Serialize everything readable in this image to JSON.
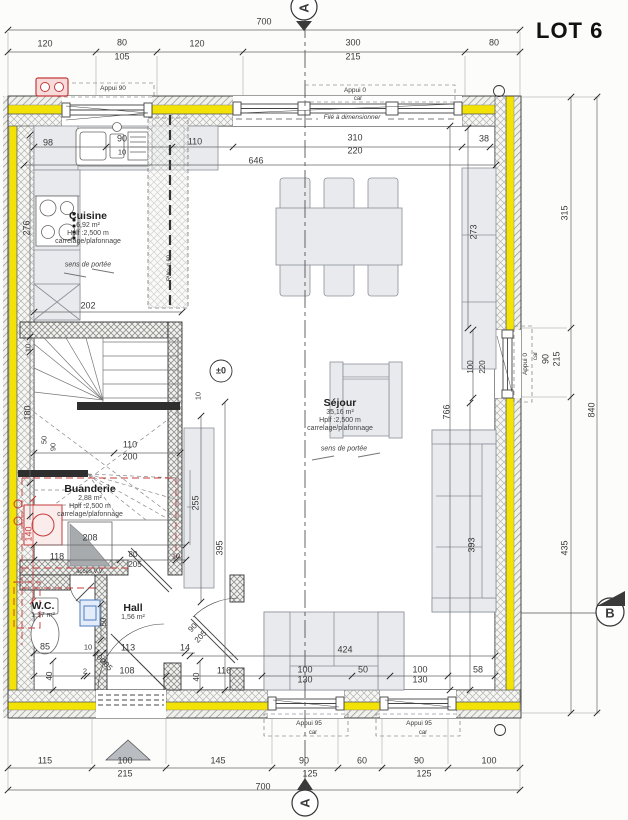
{
  "title": "LOT 6",
  "section_markers": {
    "top": "A",
    "bottom": "A",
    "right": "B"
  },
  "level_marker": "±0",
  "colors": {
    "insulation": "#f2e205",
    "plumbing_red": "#c43b3b",
    "panel_blue": "#5b86c5",
    "furniture": "#e8eaed"
  },
  "rooms": [
    {
      "key": "cuisine",
      "name": "Cuisine",
      "area": "6,92 m²",
      "height": "Hplf :2,500 m",
      "finish": "carrelage/plafonnage",
      "cx": 88,
      "cy": 228
    },
    {
      "key": "sejour",
      "name": "Séjour",
      "area": "35,16 m²",
      "height": "Hplf :2,500 m",
      "finish": "carrelage/plafonnage",
      "cx": 340,
      "cy": 415
    },
    {
      "key": "buanderie",
      "name": "Buanderie",
      "area": "2,88 m²",
      "height": "Hplf :2,500 m",
      "finish": "carrelage/plafonnage",
      "cx": 90,
      "cy": 501
    },
    {
      "key": "hall",
      "name": "Hall",
      "area": "1,56 m²",
      "height": "",
      "finish": "",
      "cx": 133,
      "cy": 612
    },
    {
      "key": "wc",
      "name": "W.C.",
      "area": "1,17 m²",
      "height": "",
      "finish": "",
      "cx": 43,
      "cy": 610
    }
  ],
  "labels": [
    {
      "t": "700",
      "x": 264,
      "y": 22
    },
    {
      "t": "120",
      "x": 45,
      "y": 44
    },
    {
      "t": "80",
      "x": 122,
      "y": 43
    },
    {
      "t": "105",
      "x": 122,
      "y": 57
    },
    {
      "t": "120",
      "x": 197,
      "y": 44
    },
    {
      "t": "300",
      "x": 353,
      "y": 43
    },
    {
      "t": "215",
      "x": 353,
      "y": 57
    },
    {
      "t": "80",
      "x": 494,
      "y": 43
    },
    {
      "t": "98",
      "x": 48,
      "y": 143
    },
    {
      "t": "90",
      "x": 122,
      "y": 139
    },
    {
      "t": "10",
      "x": 122,
      "y": 152,
      "s": 7.5
    },
    {
      "t": "110",
      "x": 195,
      "y": 142
    },
    {
      "t": "310",
      "x": 355,
      "y": 138
    },
    {
      "t": "220",
      "x": 355,
      "y": 151
    },
    {
      "t": "38",
      "x": 484,
      "y": 139
    },
    {
      "t": "646",
      "x": 256,
      "y": 161
    },
    {
      "t": "273",
      "x": 474,
      "y": 232,
      "r": -90
    },
    {
      "t": "276",
      "x": 27,
      "y": 228,
      "r": -90
    },
    {
      "t": "202",
      "x": 88,
      "y": 306
    },
    {
      "t": "10",
      "x": 28,
      "y": 348,
      "r": -90,
      "s": 7.5
    },
    {
      "t": "180",
      "x": 28,
      "y": 413,
      "r": -90
    },
    {
      "t": "50",
      "x": 44,
      "y": 440,
      "r": -90,
      "s": 7.5
    },
    {
      "t": "90",
      "x": 53,
      "y": 447,
      "r": -90,
      "s": 7.5
    },
    {
      "t": "110",
      "x": 130,
      "y": 445
    },
    {
      "t": "200",
      "x": 130,
      "y": 457
    },
    {
      "t": "10",
      "x": 198,
      "y": 396,
      "r": -90,
      "s": 7.5
    },
    {
      "t": "±0",
      "x": 221,
      "y": 371,
      "s": 9,
      "b": 1,
      "n": "level-marker"
    },
    {
      "t": "100",
      "x": 471,
      "y": 367,
      "r": -90,
      "s": 8
    },
    {
      "t": "220",
      "x": 483,
      "y": 367,
      "r": -90,
      "s": 8
    },
    {
      "t": "766",
      "x": 447,
      "y": 412,
      "r": -90
    },
    {
      "t": "393",
      "x": 472,
      "y": 545,
      "r": -90
    },
    {
      "t": "255",
      "x": 196,
      "y": 503,
      "r": -90
    },
    {
      "t": "395",
      "x": 220,
      "y": 548,
      "r": -90
    },
    {
      "t": "315",
      "x": 565,
      "y": 213,
      "r": -90
    },
    {
      "t": "90",
      "x": 546,
      "y": 359,
      "r": -90
    },
    {
      "t": "215",
      "x": 557,
      "y": 359,
      "r": -90
    },
    {
      "t": "840",
      "x": 592,
      "y": 410,
      "r": -90
    },
    {
      "t": "435",
      "x": 565,
      "y": 548,
      "r": -90
    },
    {
      "t": "140",
      "x": 29,
      "y": 534,
      "r": -90,
      "c": "#c43b3b"
    },
    {
      "t": "208",
      "x": 90,
      "y": 538
    },
    {
      "t": "118",
      "x": 57,
      "y": 557
    },
    {
      "t": "80",
      "x": 133,
      "y": 555,
      "s": 8
    },
    {
      "t": "205",
      "x": 135,
      "y": 565,
      "s": 8
    },
    {
      "t": "10",
      "x": 176,
      "y": 556,
      "s": 7.5
    },
    {
      "t": "accès V.V.",
      "x": 90,
      "y": 572,
      "s": 6
    },
    {
      "t": "85",
      "x": 45,
      "y": 647
    },
    {
      "t": "10",
      "x": 88,
      "y": 647,
      "s": 7.5
    },
    {
      "t": "113",
      "x": 128,
      "y": 648
    },
    {
      "t": "14",
      "x": 185,
      "y": 648
    },
    {
      "t": "2",
      "x": 85,
      "y": 671,
      "s": 7.5
    },
    {
      "t": "108",
      "x": 127,
      "y": 671
    },
    {
      "t": "116",
      "x": 224,
      "y": 671
    },
    {
      "t": "50",
      "x": 104,
      "y": 622,
      "r": -90,
      "s": 8
    },
    {
      "t": "40",
      "x": 50,
      "y": 676,
      "r": -90,
      "s": 8
    },
    {
      "t": "40",
      "x": 197,
      "y": 677,
      "r": -90,
      "s": 8
    },
    {
      "t": "90",
      "x": 193,
      "y": 628,
      "r": -47,
      "s": 8
    },
    {
      "t": "205",
      "x": 201,
      "y": 637,
      "r": -47,
      "s": 8
    },
    {
      "t": "100",
      "x": 99,
      "y": 658,
      "r": 46,
      "s": 8
    },
    {
      "t": "205",
      "x": 106,
      "y": 665,
      "r": 46,
      "s": 8
    },
    {
      "t": "424",
      "x": 345,
      "y": 650
    },
    {
      "t": "100",
      "x": 305,
      "y": 670
    },
    {
      "t": "130",
      "x": 305,
      "y": 680
    },
    {
      "t": "50",
      "x": 363,
      "y": 670
    },
    {
      "t": "100",
      "x": 420,
      "y": 670
    },
    {
      "t": "130",
      "x": 420,
      "y": 680
    },
    {
      "t": "58",
      "x": 478,
      "y": 670
    },
    {
      "t": "115",
      "x": 45,
      "y": 761
    },
    {
      "t": "100",
      "x": 125,
      "y": 761
    },
    {
      "t": "215",
      "x": 125,
      "y": 774
    },
    {
      "t": "145",
      "x": 218,
      "y": 761
    },
    {
      "t": "90",
      "x": 304,
      "y": 761
    },
    {
      "t": "125",
      "x": 310,
      "y": 774
    },
    {
      "t": "60",
      "x": 362,
      "y": 761
    },
    {
      "t": "90",
      "x": 419,
      "y": 761
    },
    {
      "t": "125",
      "x": 424,
      "y": 774
    },
    {
      "t": "100",
      "x": 489,
      "y": 761
    },
    {
      "t": "700",
      "x": 263,
      "y": 787
    },
    {
      "t": "Appui 90",
      "x": 113,
      "y": 89,
      "s": 6.5,
      "n": "window-sill-note"
    },
    {
      "t": "Appui 0",
      "x": 355,
      "y": 91,
      "s": 6.5,
      "n": "window-sill-note"
    },
    {
      "t": "car",
      "x": 358,
      "y": 99,
      "s": 6
    },
    {
      "t": "Filé à dimensionner",
      "x": 352,
      "y": 118,
      "s": 6.5,
      "i": 1,
      "n": "beam-note"
    },
    {
      "t": "Appui 0",
      "x": 526,
      "y": 364,
      "r": -90,
      "s": 6.5,
      "n": "window-sill-note"
    },
    {
      "t": "car",
      "x": 536,
      "y": 356,
      "r": -90,
      "s": 6
    },
    {
      "t": "Appui 95",
      "x": 309,
      "y": 724,
      "s": 6.5,
      "n": "window-sill-note"
    },
    {
      "t": "car",
      "x": 313,
      "y": 733,
      "s": 6
    },
    {
      "t": "Appui 95",
      "x": 419,
      "y": 724,
      "s": 6.5,
      "n": "window-sill-note"
    },
    {
      "t": "car",
      "x": 423,
      "y": 733,
      "s": 6
    },
    {
      "t": "RWa d.60",
      "x": 170,
      "y": 268,
      "r": -90,
      "s": 6,
      "n": "downpipe-note"
    },
    {
      "t": "sens de portée",
      "x": 88,
      "y": 265,
      "s": 7,
      "i": 1,
      "n": "span-direction-note"
    },
    {
      "t": "sens de portée",
      "x": 344,
      "y": 449,
      "s": 7,
      "i": 1,
      "n": "span-direction-note"
    },
    {
      "t": "A",
      "x": 304,
      "y": 8,
      "r": -90,
      "s": 13,
      "b": 1,
      "n": "section-letter-top"
    },
    {
      "t": "A",
      "x": 305,
      "y": 803,
      "r": -90,
      "s": 13,
      "b": 1,
      "n": "section-letter-bottom"
    },
    {
      "t": "B",
      "x": 610,
      "y": 613,
      "s": 13,
      "b": 1,
      "n": "section-letter-right"
    }
  ]
}
